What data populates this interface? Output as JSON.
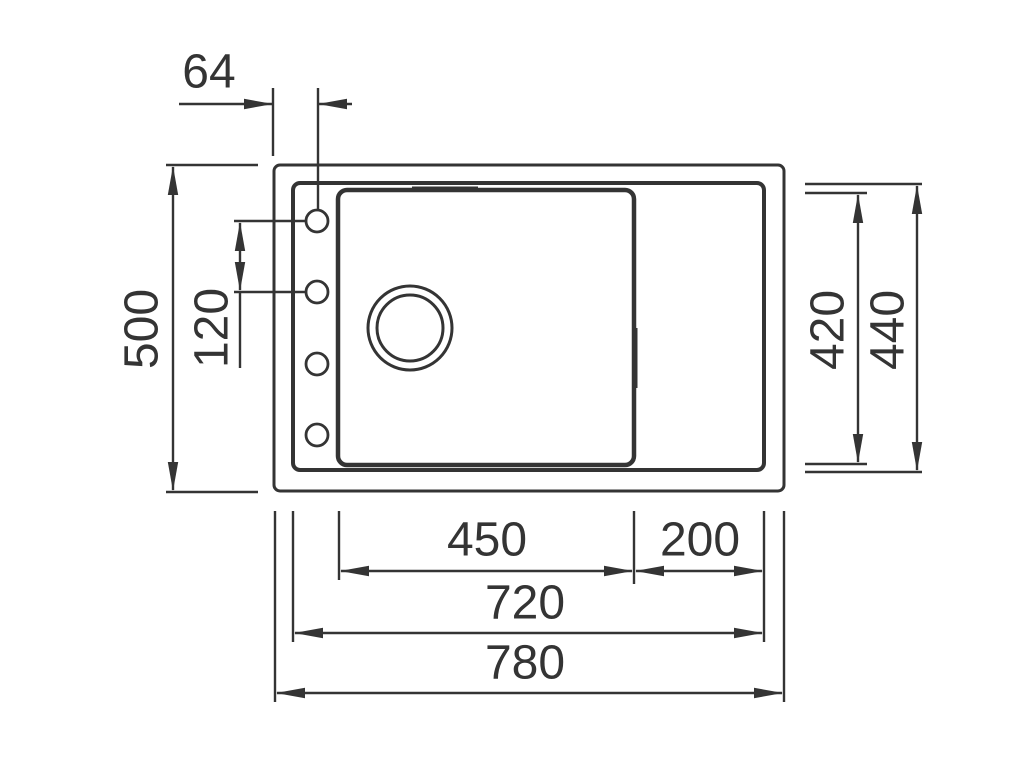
{
  "drawing": {
    "description": "Kitchen sink top-view technical dimension drawing",
    "line_color": "#343434",
    "dims": {
      "tap_hole_offset": "64",
      "overall_depth": "500",
      "tap_hole_pitch": "120",
      "bowl_depth": "420",
      "rim_depth": "440",
      "bowl_width": "450",
      "drainer_width": "200",
      "rim_width": "720",
      "overall_width": "780"
    }
  }
}
